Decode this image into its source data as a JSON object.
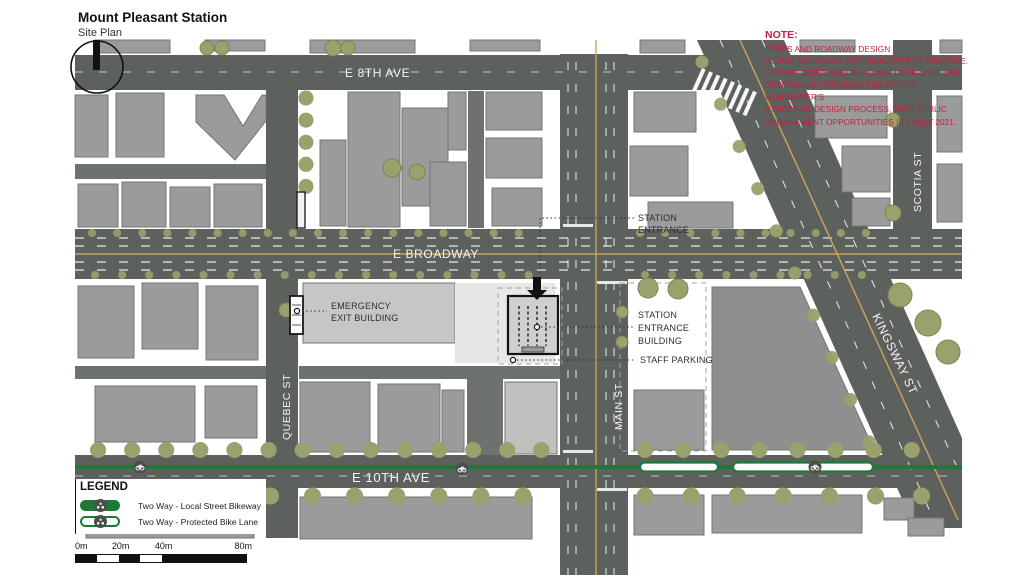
{
  "title": {
    "main": "Mount Pleasant Station",
    "sub": "Site Plan"
  },
  "note": {
    "heading": "NOTE:",
    "lines": [
      "TREES AND ROADWAY DESIGN",
      "ALONG BROADWAY ARE INDICATIVE AT THIS TIME.",
      "FUTURE TREES AND ROADWAY DESIGN WILL BE",
      "DETERMINED THROUGH THE CITY OF VANCOUVER'S",
      "STREET RE-DESIGN PROCESS, WITH PUBLIC",
      "ENGAGEMENT OPPORTUNITIES IN EARLY 2021."
    ]
  },
  "streets": {
    "e8th": "E 8TH AVE",
    "broadway": "E BROADWAY",
    "e10th": "E 10TH AVE",
    "quebec": "QUEBEC ST",
    "main": "MAIN ST",
    "scotia": "SCOTIA ST",
    "kingsway": "KINGSWAY ST"
  },
  "callouts": {
    "station_entrance": [
      "STATION",
      "ENTRANCE"
    ],
    "emergency_exit": [
      "EMERGENCY",
      "EXIT BUILDING"
    ],
    "entrance_building": [
      "STATION",
      "ENTRANCE",
      "BUILDING"
    ],
    "staff_parking": "STAFF PARKING"
  },
  "legend": {
    "heading": "LEGEND",
    "items": [
      {
        "label": "Two Way - Local Street Bikeway",
        "style": "solid"
      },
      {
        "label": "Two Way - Protected Bike Lane",
        "style": "outline"
      }
    ]
  },
  "scalebar": {
    "labels": [
      "0m",
      "20m",
      "40m",
      "80m"
    ]
  },
  "colors": {
    "road": "#5d615e",
    "building_gray": "#9b9b9b",
    "tree_olive": "#99a16d",
    "bikeway_green": "#1d7a36",
    "note_red": "#c41f3e",
    "centerline_tan": "#c9a063"
  }
}
